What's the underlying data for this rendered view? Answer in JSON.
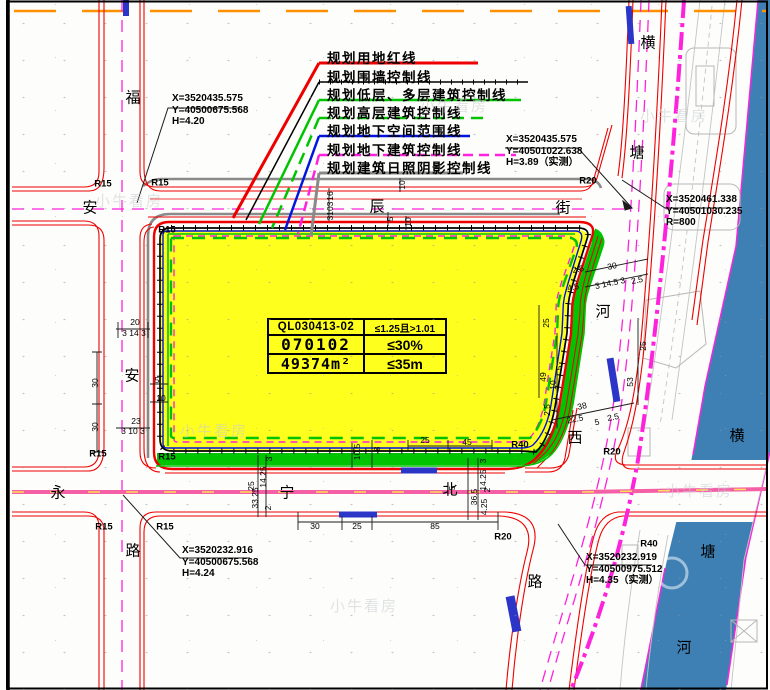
{
  "colors": {
    "red": "#ee0000",
    "black": "#000000",
    "green": "#00c400",
    "blue": "#0015e0",
    "magenta": "#ff22dd",
    "gray": "#8a8a8a",
    "orange": "#ff9100",
    "pink": "#f45fa6",
    "pinkdash": "#ffdf55",
    "yellow": "#ffff1e",
    "river": "#3e80b4",
    "busstop": "#2b35c8"
  },
  "legend": {
    "items": [
      {
        "label": "规划用地红线"
      },
      {
        "label": "规划围墙控制线"
      },
      {
        "label": "规划低层、多层建筑控制线"
      },
      {
        "label": "规划高层建筑控制线"
      },
      {
        "label": "规划地下空间范围线"
      },
      {
        "label": "规划地下建筑控制线"
      },
      {
        "label": "规划建筑日照阴影控制线"
      }
    ]
  },
  "parcel_table": {
    "rows": [
      [
        "QL030413-02",
        "≤1.25且>1.01"
      ],
      [
        "070102",
        "≤30%"
      ],
      [
        "49374m²",
        "≤35m"
      ]
    ]
  },
  "callouts": [
    {
      "lines": [
        "X=3520435.575",
        "Y=40500675.568",
        "H=4.20"
      ]
    },
    {
      "lines": [
        "X=3520435.575",
        "Y=40501022.638",
        "H=3.89（实测）"
      ]
    },
    {
      "lines": [
        "X=3520461.338",
        "Y=40501030.235",
        "R=800"
      ]
    },
    {
      "lines": [
        "X=3520232.916",
        "Y=40500675.568",
        "H=4.24"
      ]
    },
    {
      "lines": [
        "X=3520232.919",
        "Y=40500975.512",
        "H=4.35（实测）"
      ]
    }
  ],
  "street_labels": [
    {
      "t": "福",
      "x": 133,
      "y": 97
    },
    {
      "t": "安",
      "x": 132,
      "y": 375
    },
    {
      "t": "路",
      "x": 133,
      "y": 550
    },
    {
      "t": "安",
      "x": 90,
      "y": 207
    },
    {
      "t": "辰",
      "x": 377,
      "y": 206
    },
    {
      "t": "街",
      "x": 563,
      "y": 207
    },
    {
      "t": "永",
      "x": 58,
      "y": 492
    },
    {
      "t": "宁",
      "x": 287,
      "y": 492
    },
    {
      "t": "北",
      "x": 450,
      "y": 489
    },
    {
      "t": "横",
      "x": 648,
      "y": 42
    },
    {
      "t": "塘",
      "x": 637,
      "y": 152
    },
    {
      "t": "河",
      "x": 603,
      "y": 311
    },
    {
      "t": "西",
      "x": 575,
      "y": 437
    },
    {
      "t": "路",
      "x": 535,
      "y": 581
    },
    {
      "t": "横",
      "x": 737,
      "y": 435
    },
    {
      "t": "塘",
      "x": 708,
      "y": 551
    },
    {
      "t": "河",
      "x": 684,
      "y": 647
    }
  ],
  "radius_labels": [
    {
      "t": "R15",
      "x": 103,
      "y": 184
    },
    {
      "t": "R15",
      "x": 160,
      "y": 183
    },
    {
      "t": "R15",
      "x": 167,
      "y": 230
    },
    {
      "t": "R15",
      "x": 98,
      "y": 454
    },
    {
      "t": "R15",
      "x": 167,
      "y": 457
    },
    {
      "t": "R15",
      "x": 104,
      "y": 527
    },
    {
      "t": "R15",
      "x": 165,
      "y": 527
    },
    {
      "t": "R20",
      "x": 588,
      "y": 181
    },
    {
      "t": "R20",
      "x": 612,
      "y": 452
    },
    {
      "t": "R20",
      "x": 503,
      "y": 537
    },
    {
      "t": "R40",
      "x": 520,
      "y": 445
    },
    {
      "t": "R40",
      "x": 649,
      "y": 544
    }
  ],
  "dim_labels": [
    {
      "t": "20",
      "x": 135,
      "y": 322
    },
    {
      "t": "3 14 3",
      "x": 134,
      "y": 333
    },
    {
      "t": "30",
      "x": 95,
      "y": 383,
      "r": -90
    },
    {
      "t": "30",
      "x": 95,
      "y": 427,
      "r": -90
    },
    {
      "t": "5",
      "x": 157,
      "y": 380
    },
    {
      "t": "10",
      "x": 161,
      "y": 398
    },
    {
      "t": "23",
      "x": 136,
      "y": 421
    },
    {
      "t": "3 10 3",
      "x": 133,
      "y": 431
    },
    {
      "t": "16",
      "x": 330,
      "y": 196,
      "r": -90
    },
    {
      "t": "3",
      "x": 330,
      "y": 204,
      "r": -90
    },
    {
      "t": "10",
      "x": 330,
      "y": 211,
      "r": -90
    },
    {
      "t": "3",
      "x": 330,
      "y": 218,
      "r": -90
    },
    {
      "t": "10",
      "x": 402,
      "y": 185,
      "r": -90
    },
    {
      "t": "5",
      "x": 390,
      "y": 219,
      "r": -90
    },
    {
      "t": "10",
      "x": 408,
      "y": 222,
      "r": -90
    },
    {
      "t": "30",
      "x": 612,
      "y": 266,
      "r": -12
    },
    {
      "t": "3 14.5 3",
      "x": 610,
      "y": 283,
      "r": -12
    },
    {
      "t": "2.5",
      "x": 578,
      "y": 269,
      "r": -12
    },
    {
      "t": "4.5",
      "x": 573,
      "y": 287,
      "r": -12
    },
    {
      "t": "2.5",
      "x": 637,
      "y": 280,
      "r": -12
    },
    {
      "t": "25",
      "x": 546,
      "y": 323,
      "r": -90
    },
    {
      "t": "49",
      "x": 543,
      "y": 377,
      "r": -90
    },
    {
      "t": "5",
      "x": 559,
      "y": 368,
      "r": -90
    },
    {
      "t": "10",
      "x": 553,
      "y": 385,
      "r": -90
    },
    {
      "t": "2.5",
      "x": 547,
      "y": 410,
      "r": -90
    },
    {
      "t": "25",
      "x": 643,
      "y": 346,
      "r": -90
    },
    {
      "t": "53",
      "x": 630,
      "y": 382,
      "r": -90
    },
    {
      "t": "38",
      "x": 582,
      "y": 406,
      "r": -12
    },
    {
      "t": "22.5",
      "x": 575,
      "y": 419,
      "r": -12
    },
    {
      "t": "5",
      "x": 597,
      "y": 422,
      "r": -12
    },
    {
      "t": "2.5",
      "x": 613,
      "y": 417,
      "r": -12
    },
    {
      "t": "30",
      "x": 315,
      "y": 526
    },
    {
      "t": "25",
      "x": 357,
      "y": 526
    },
    {
      "t": "85",
      "x": 435,
      "y": 526
    },
    {
      "t": "36.5",
      "x": 474,
      "y": 497,
      "r": -90
    },
    {
      "t": "14.25",
      "x": 483,
      "y": 480,
      "r": -90
    },
    {
      "t": "3",
      "x": 483,
      "y": 461,
      "r": -90
    },
    {
      "t": "4.25",
      "x": 484,
      "y": 507,
      "r": -90
    },
    {
      "t": "2",
      "x": 487,
      "y": 490,
      "r": -90
    },
    {
      "t": "5",
      "x": 452,
      "y": 488,
      "r": -90
    },
    {
      "t": "33.25",
      "x": 255,
      "y": 498,
      "r": -90
    },
    {
      "t": "14.25",
      "x": 263,
      "y": 477,
      "r": -90
    },
    {
      "t": "3",
      "x": 269,
      "y": 459,
      "r": -90
    },
    {
      "t": "25",
      "x": 251,
      "y": 486,
      "r": -90
    },
    {
      "t": "2",
      "x": 268,
      "y": 508,
      "r": -90
    },
    {
      "t": "10.5",
      "x": 357,
      "y": 452,
      "r": -90
    },
    {
      "t": "8",
      "x": 377,
      "y": 449,
      "r": -90
    },
    {
      "t": "25",
      "x": 425,
      "y": 440
    },
    {
      "t": "45",
      "x": 467,
      "y": 442
    }
  ],
  "watermark": {
    "text": "小牛看房",
    "positions": [
      [
        95,
        190
      ],
      [
        420,
        95
      ],
      [
        180,
        420
      ],
      [
        330,
        595
      ],
      [
        640,
        105
      ],
      [
        665,
        480
      ]
    ]
  }
}
